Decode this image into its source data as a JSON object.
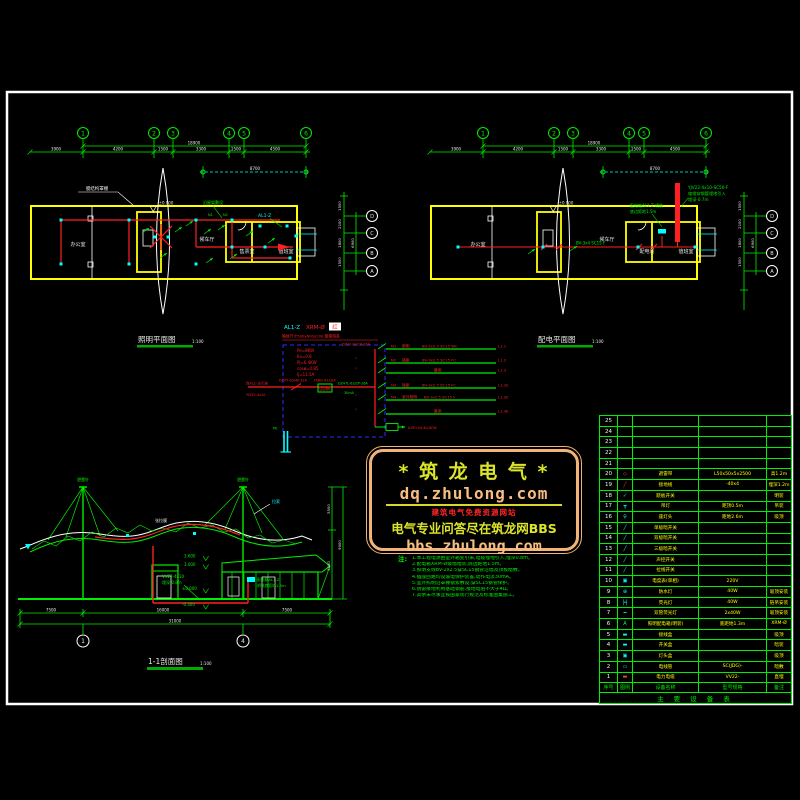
{
  "plan_common": {
    "grid_bubbles": [
      "1",
      "2",
      "3",
      "4",
      "5",
      "6"
    ],
    "dims": [
      "3900",
      "4200",
      "1500",
      "3300",
      "1500",
      "4500"
    ],
    "dim_total": "18900",
    "dim_secondary": "8700",
    "row_bubbles": [
      "D",
      "C",
      "B",
      "A"
    ],
    "side_dims": [
      "1500",
      "2100",
      "1800",
      "1500"
    ],
    "side_total": "6900",
    "level": "±0.000"
  },
  "plan_left": {
    "title": "照明平面图",
    "scale": "1:100",
    "rooms": [
      "办公室",
      "候车厅",
      "售票室",
      "值班室"
    ],
    "roof_note": "膜结构罩棚",
    "wire_note": "沿屋架敷设",
    "panel_label": "AL1-Z",
    "circuits": [
      "N1",
      "N2"
    ]
  },
  "plan_right": {
    "title": "配电平面图",
    "scale": "1:100",
    "rooms": [
      "办公室",
      "候车厅",
      "配电间",
      "值班室"
    ],
    "cable_notes": [
      "YJV22-4x10-SC50-F",
      "电缆穿钢管埋地引入",
      "埋深-0.7m"
    ],
    "panel_notes": [
      "配电箱AL1-Z 明装",
      "底边距地1.5m"
    ],
    "feeder_label": "BV-3x4 SC15 F"
  },
  "schematic": {
    "panel_id": "AL1-Z",
    "panel_model": "XRM-Ø",
    "panel_tag": "红",
    "box_note": "箱体尺寸500x600x200 嵌墙暗装",
    "params": [
      "Pe=8KW",
      "Kx=0.8",
      "Pj=6.4KW",
      "cosø=0.85",
      "Ij=11.5A"
    ],
    "incoming_source": "自AL2-1b引来",
    "incoming_cable": "YJV22-4x10",
    "main_breaker": "DZ47-63/4P-32A",
    "meter_label": "FDBo-63(3)A",
    "meter_text": "DD86",
    "rows": [
      {
        "breaker": "DZ47-63/1P-16A",
        "rcd": "",
        "no": "N1",
        "name": "照明",
        "cable": "BV-2x2.5 SC15 WC",
        "id": "L1.1"
      },
      {
        "breaker": "〃",
        "rcd": "",
        "no": "N2",
        "name": "插座",
        "cable": "BV-3x2.5 SC15 FC",
        "id": "L1.2"
      },
      {
        "breaker": "〃",
        "rcd": "",
        "no": "",
        "name": "备用",
        "cable": "",
        "id": "L1.3"
      },
      {
        "breaker": "DZ47L-63/2P-16A",
        "rcd": "30mA",
        "no": "N3",
        "name": "插座",
        "cable": "BV-3x2.5 SC15 FC",
        "id": "L1.1E"
      },
      {
        "breaker": "〃",
        "rcd": "",
        "no": "N4",
        "name": "室外照明",
        "cable": "BV-3x2.5 SC15 F",
        "id": "L1.2E"
      },
      {
        "breaker": "〃",
        "rcd": "",
        "no": "",
        "name": "备用",
        "cable": "",
        "id": "L1.3E"
      }
    ],
    "surge_label": "JLSP-U/4-40/4CW",
    "pe_label": "PE"
  },
  "elevation": {
    "title": "1-1剖面图",
    "scale": "1:100",
    "mast_label": "避雷针",
    "cable_label": "拉索",
    "canopy_label": "张拉膜",
    "levels": [
      "3.600",
      "3.000",
      "±0.000",
      "-0.300"
    ],
    "panel_notes": [
      "配电箱AL1-Z",
      "明装底距地1.5m"
    ],
    "buried_notes": [
      "VV22-4x10",
      "埋深-0.8m"
    ],
    "dims": [
      "7500",
      "16000",
      "7500"
    ],
    "dim_total": "31000",
    "side_dims": [
      "5500",
      "3500"
    ],
    "side_total": "9000",
    "grid_bubbles": [
      "1",
      "4"
    ]
  },
  "watermark": {
    "title": "* 筑 龙 电 气 *",
    "url_top": "dq.zhulong.com",
    "subtitle": "建筑电气免费资源网站",
    "tagline": "电气专业问答尽在筑龙网BBS",
    "url_bottom": "bbs.zhulong.com"
  },
  "notes": {
    "label": "注:",
    "lines": [
      "1.本工程电源由室外箱变引来,电缆埋地引入,埋深0.8m。",
      "2.配电箱XRM-Ø嵌墙暗装,底边距地1.5m。",
      "3.照明支线BV-2x2.5穿SC15钢管沿墙及顶板暗敷。",
      "4.插座回路均设漏电保护装置,动作电流30mA。",
      "5.室外照明沿罩棚钢索敷设,穿SC15钢管保护。",
      "6.防雷接地利用基础钢筋,接地电阻不大于4Ω。",
      "7.其余未尽事宜按国家现行规范及标准图集施工。"
    ]
  },
  "table": {
    "title": "主 要 设 备 表",
    "headers": [
      "序号",
      "图例",
      "设备名称",
      "型号规格",
      "备注"
    ],
    "rows": [
      {
        "no": "25",
        "sym": "",
        "color": "",
        "name": "",
        "spec": "",
        "remark": ""
      },
      {
        "no": "24",
        "sym": "",
        "color": "",
        "name": "",
        "spec": "",
        "remark": ""
      },
      {
        "no": "23",
        "sym": "",
        "color": "",
        "name": "",
        "spec": "",
        "remark": ""
      },
      {
        "no": "22",
        "sym": "",
        "color": "",
        "name": "",
        "spec": "",
        "remark": ""
      },
      {
        "no": "21",
        "sym": "",
        "color": "",
        "name": "",
        "spec": "",
        "remark": ""
      },
      {
        "no": "20",
        "sym": "◇",
        "color": "#ff4040",
        "name": "避雷带",
        "spec": "L50x50x5x2500",
        "remark": "高1.2m"
      },
      {
        "no": "19",
        "sym": "╱",
        "color": "#ff4040",
        "name": "接地线",
        "spec": "-40x4",
        "remark": "埋深1.2m"
      },
      {
        "no": "18",
        "sym": "✓",
        "color": "#00ffff",
        "name": "跷板开关",
        "spec": "",
        "remark": "明装"
      },
      {
        "no": "17",
        "sym": "┳",
        "color": "#00ffff",
        "name": "吊灯",
        "spec": "距顶0.5m",
        "remark": "吊装"
      },
      {
        "no": "16",
        "sym": "♀",
        "color": "#00ffff",
        "name": "座灯头",
        "spec": "距地2.6m",
        "remark": "吸顶"
      },
      {
        "no": "15",
        "sym": "╱",
        "color": "#00ffff",
        "name": "单极暗开关",
        "spec": "",
        "remark": ""
      },
      {
        "no": "14",
        "sym": "╱",
        "color": "#00ffff",
        "name": "双极暗开关",
        "spec": "",
        "remark": ""
      },
      {
        "no": "13",
        "sym": "╱",
        "color": "#00ffff",
        "name": "三极暗开关",
        "spec": "",
        "remark": ""
      },
      {
        "no": "12",
        "sym": "╱",
        "color": "#00ffff",
        "name": "声控开关",
        "spec": "",
        "remark": ""
      },
      {
        "no": "11",
        "sym": "╱",
        "color": "#00ffff",
        "name": "拉线开关",
        "spec": "",
        "remark": ""
      },
      {
        "no": "10",
        "sym": "▣",
        "color": "#00ffff",
        "name": "电度表(单相)",
        "spec": "220V",
        "remark": ""
      },
      {
        "no": "9",
        "sym": "⊕",
        "color": "#00ffff",
        "name": "防水灯",
        "spec": "40W",
        "remark": "吸顶安装"
      },
      {
        "no": "8",
        "sym": "╞╡",
        "color": "#00ffff",
        "name": "荧光灯",
        "spec": "40W",
        "remark": "链吊安装"
      },
      {
        "no": "7",
        "sym": "━",
        "color": "#00ffff",
        "name": "双管荧光灯",
        "spec": "2x40W",
        "remark": "吸顶安装"
      },
      {
        "no": "6",
        "sym": "A",
        "color": "#00ff66",
        "name": "照明配电箱(明装)",
        "spec": "底距地1.3m",
        "remark": "XRM-Ø"
      },
      {
        "no": "5",
        "sym": "▬",
        "color": "#00ffff",
        "name": "接线盒",
        "spec": "",
        "remark": "吸顶"
      },
      {
        "no": "4",
        "sym": "▬",
        "color": "#00ffff",
        "name": "开关盒",
        "spec": "",
        "remark": "暗装"
      },
      {
        "no": "3",
        "sym": "▣",
        "color": "#00ffff",
        "name": "灯头盒",
        "spec": "",
        "remark": "吸顶"
      },
      {
        "no": "2",
        "sym": "▭",
        "color": "#00ffff",
        "name": "电线管",
        "spec": "SC(JDG)-",
        "remark": "暗敷"
      },
      {
        "no": "1",
        "sym": "▬",
        "color": "#ff4040",
        "name": "电力电缆",
        "spec": "VV22-",
        "remark": "直埋"
      }
    ]
  }
}
